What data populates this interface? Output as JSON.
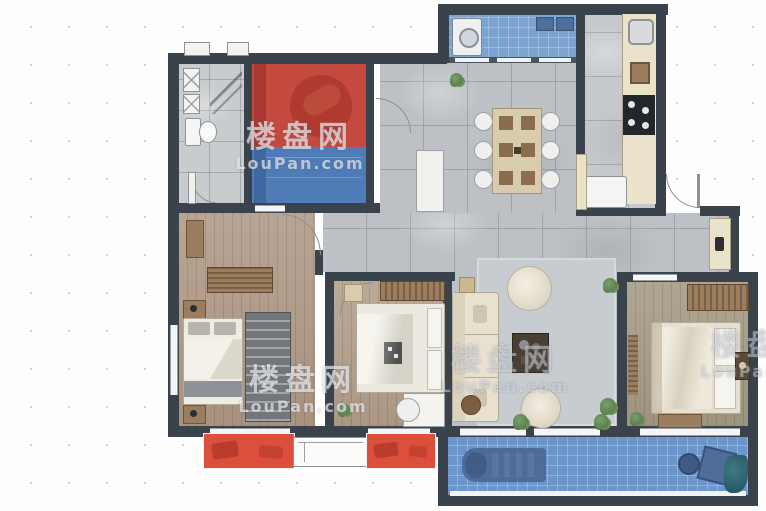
{
  "watermark": {
    "text_cn": "楼盘网",
    "text_en": "LouPan.com"
  },
  "colors": {
    "wall": "#3a434b",
    "tile": "#bdc1c5",
    "kitchen_tile": "#c6c9cc",
    "bath_tile": "#c9cccf",
    "wood_left": "#b19b88",
    "wood_mid": "#b4a08d",
    "wood_master": "#a69c86",
    "highlight_red": "#c4493e",
    "highlight_blue": "#4f7cb6",
    "balcony_blue": "#6c96ca",
    "laundry_blue": "#7ba4d1",
    "bay_window_red": "#dc4f3c",
    "counter_cream": "#eae2c9",
    "rug_gray": "#c7ccd1",
    "sofa_cream": "#e9e1d0",
    "furniture_wood": "#9b7d5f",
    "door_arc": "#8a9199"
  }
}
